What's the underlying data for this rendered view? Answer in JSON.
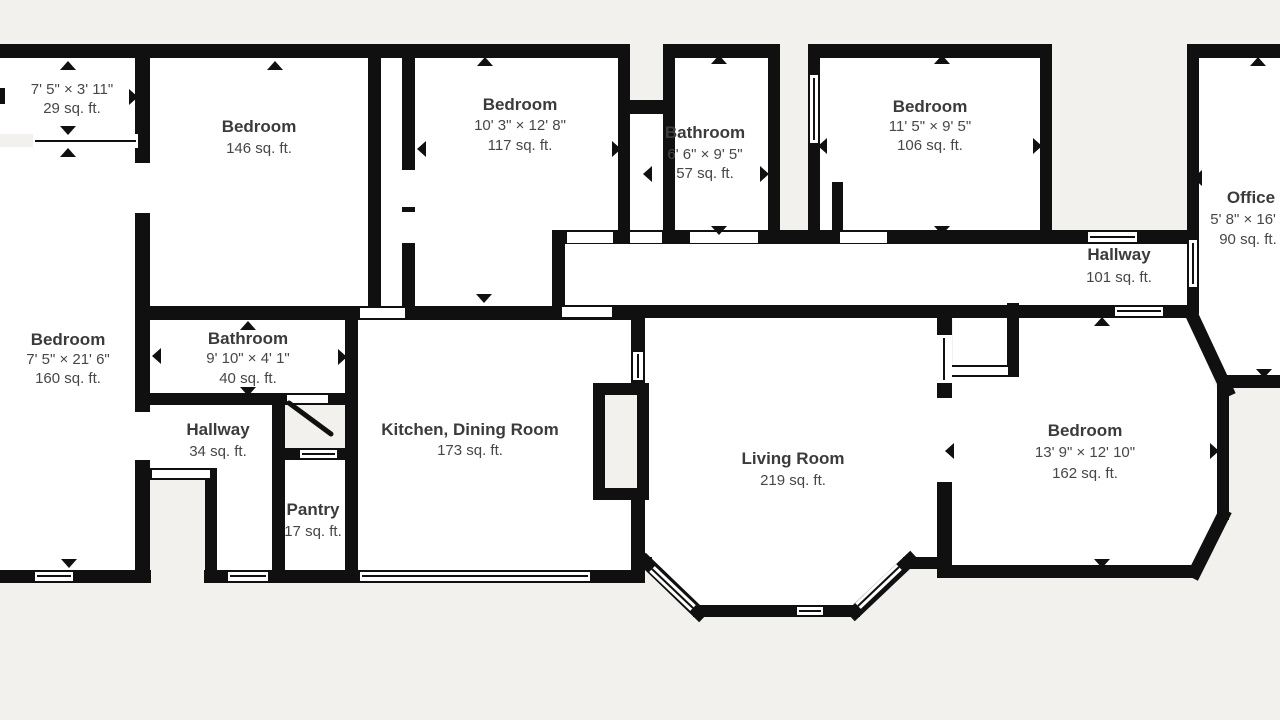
{
  "floorplan": {
    "type": "residential-floor-plan",
    "colors": {
      "background": "#f2f1ee",
      "wall": "#101010",
      "room_fill": "#ffffff",
      "label_primary": "#3b3b3b",
      "label_secondary": "#474747",
      "marker": "#101010"
    },
    "rooms": [
      {
        "name": "",
        "dimensions": "7' 5\" × 3' 11\"",
        "area": "29 sq. ft."
      },
      {
        "name": "Bedroom",
        "dimensions": "",
        "area": "146 sq. ft."
      },
      {
        "name": "Bedroom",
        "dimensions": "10' 3\" × 12' 8\"",
        "area": "117 sq. ft."
      },
      {
        "name": "Bathroom",
        "dimensions": "6' 6\" × 9' 5\"",
        "area": "57 sq. ft."
      },
      {
        "name": "Bedroom",
        "dimensions": "11' 5\" × 9' 5\"",
        "area": "106 sq. ft."
      },
      {
        "name": "Office",
        "dimensions": "5' 8\" × 16' 7\"",
        "area": "90 sq. ft."
      },
      {
        "name": "Hallway",
        "dimensions": "",
        "area": "101 sq. ft."
      },
      {
        "name": "Bedroom",
        "dimensions": "7' 5\" × 21' 6\"",
        "area": "160 sq. ft."
      },
      {
        "name": "Bathroom",
        "dimensions": "9' 10\" × 4' 1\"",
        "area": "40 sq. ft."
      },
      {
        "name": "Hallway",
        "dimensions": "",
        "area": "34 sq. ft."
      },
      {
        "name": "Kitchen, Dining Room",
        "dimensions": "",
        "area": "173 sq. ft."
      },
      {
        "name": "Pantry",
        "dimensions": "",
        "area": "17 sq. ft."
      },
      {
        "name": "Living Room",
        "dimensions": "",
        "area": "219 sq. ft."
      },
      {
        "name": "Bedroom",
        "dimensions": "13' 9\" × 12' 10\"",
        "area": "162 sq. ft."
      }
    ]
  }
}
